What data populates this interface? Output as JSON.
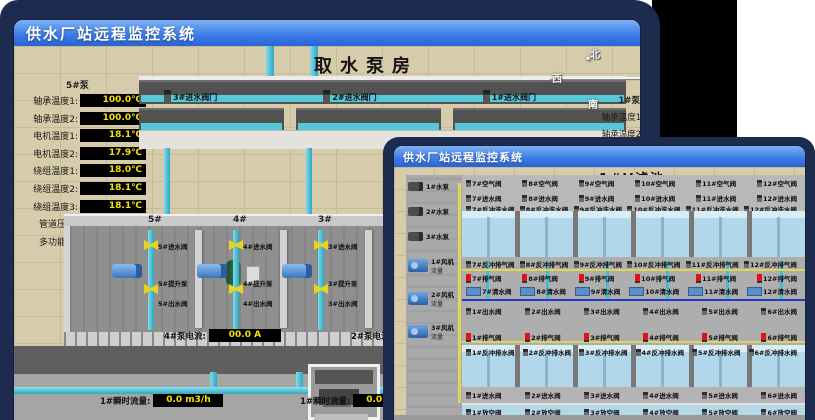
{
  "colors": {
    "background_navy": "#1d2b4e",
    "titlebar_top": "#7db1f5",
    "titlebar_bottom": "#2a63d4",
    "floor_tan": "#d6cbaa",
    "pipe_cyan": "#45bcd4",
    "pool_blue": "#b3d7ea",
    "value_yellow": "#f6e200",
    "valve_yellow": "#e8d41e",
    "alarm_red": "#e11212"
  },
  "back_window": {
    "title": "供水厂站远程监控系统",
    "scene_title": "取水泵房",
    "pump_panel": {
      "header": "5#泵",
      "readings": [
        {
          "label": "轴承温度1:",
          "value": "100.0℃"
        },
        {
          "label": "轴承温度2:",
          "value": "100.0℃"
        },
        {
          "label": "电机温度1:",
          "value": "18.1℃"
        },
        {
          "label": "电机温度2:",
          "value": "17.9℃"
        },
        {
          "label": "绕组温度1:",
          "value": "18.0℃"
        },
        {
          "label": "绕组温度2:",
          "value": "18.1℃"
        },
        {
          "label": "绕组温度3:",
          "value": "18.1℃"
        },
        {
          "label": "管道压力:",
          "value": "0.0007MPa"
        },
        {
          "label": "多功能阀:",
          "value": "0%"
        }
      ]
    },
    "intake_valves": [
      "3#进水阀门",
      "2#进水阀门",
      "1#进水阀门"
    ],
    "compass": {
      "north": "北",
      "west": "西",
      "south": "南",
      "east": "东"
    },
    "right_panel": {
      "header": "1#泵",
      "labels": [
        "轴承温度1:",
        "轴承温度2:"
      ]
    },
    "pump_bays": [
      {
        "bay": "5#",
        "inlet": "5#进水阀",
        "pump": "5#提升泵",
        "outlet": "5#出水阀"
      },
      {
        "bay": "4#",
        "inlet": "4#进水阀",
        "pump": "4#提升泵",
        "outlet": "4#出水阀"
      },
      {
        "bay": "3#",
        "inlet": "3#进水阀",
        "pump": "3#提升泵",
        "outlet": "3#出水阀"
      }
    ],
    "current_readings": [
      {
        "label": "4#泵电流:",
        "value": "00.0 A"
      },
      {
        "label": "2#泵电流:",
        "value": ""
      }
    ],
    "flow_readings": [
      {
        "label": "1#瞬时流量:",
        "value": "0.0 m3/h"
      },
      {
        "label": "1#瞬时流量:",
        "value": "0.0 m3/h"
      }
    ]
  },
  "front_window": {
    "title": "供水厂站远程监控系统",
    "scene_title": "1#V滤池",
    "left_equipment": {
      "pumps": [
        "1#水泵",
        "2#水泵",
        "3#水泵"
      ],
      "blowers": [
        {
          "name": "1#风机",
          "sub": "流量"
        },
        {
          "name": "2#风机",
          "sub": "流量"
        },
        {
          "name": "3#风机",
          "sub": "流量"
        }
      ]
    },
    "top_cells": [
      {
        "id": "7#",
        "air": "7#空气阀",
        "inlet": "7#进水阀",
        "backwash": "7#反冲洗水阀",
        "bw_vent": "7#反冲排气阀",
        "vent": "7#排气阀",
        "clean": "7#清水阀"
      },
      {
        "id": "8#",
        "air": "8#空气阀",
        "inlet": "8#进水阀",
        "backwash": "8#反冲洗水阀",
        "bw_vent": "8#反冲排气阀",
        "vent": "8#排气阀",
        "clean": "8#清水阀"
      },
      {
        "id": "9#",
        "air": "9#空气阀",
        "inlet": "9#进水阀",
        "backwash": "9#反冲洗水阀",
        "bw_vent": "9#反冲排气阀",
        "vent": "9#排气阀",
        "clean": "9#清水阀"
      },
      {
        "id": "10#",
        "air": "10#空气阀",
        "inlet": "10#进水阀",
        "backwash": "10#反冲洗水阀",
        "bw_vent": "10#反冲排气阀",
        "vent": "10#排气阀",
        "clean": "10#清水阀"
      },
      {
        "id": "11#",
        "air": "11#空气阀",
        "inlet": "11#进水阀",
        "backwash": "11#反冲洗水阀",
        "bw_vent": "11#反冲排气阀",
        "vent": "11#排气阀",
        "clean": "11#清水阀"
      },
      {
        "id": "12#",
        "air": "12#空气阀",
        "inlet": "12#进水阀",
        "backwash": "12#反冲洗水阀",
        "bw_vent": "12#反冲排气阀",
        "vent": "12#排气阀",
        "clean": "12#清水阀"
      }
    ],
    "bottom_cells": [
      {
        "id": "1#",
        "outlet": "1#出水阀",
        "vent": "1#排气阀",
        "drain": "1#反冲排水阀",
        "inlet": "1#进水阀",
        "empty": "1#放空阀"
      },
      {
        "id": "2#",
        "outlet": "2#出水阀",
        "vent": "2#排气阀",
        "drain": "2#反冲排水阀",
        "inlet": "2#进水阀",
        "empty": "2#放空阀"
      },
      {
        "id": "3#",
        "outlet": "3#出水阀",
        "vent": "3#排气阀",
        "drain": "3#反冲排水阀",
        "inlet": "3#进水阀",
        "empty": "3#放空阀"
      },
      {
        "id": "4#",
        "outlet": "4#出水阀",
        "vent": "4#排气阀",
        "drain": "4#反冲排水阀",
        "inlet": "4#进水阀",
        "empty": "4#放空阀"
      },
      {
        "id": "5#",
        "outlet": "5#出水阀",
        "vent": "5#排气阀",
        "drain": "5#反冲排水阀",
        "inlet": "5#进水阀",
        "empty": "5#放空阀"
      },
      {
        "id": "6#",
        "outlet": "6#出水阀",
        "vent": "6#排气阀",
        "drain": "6#反冲排水阀",
        "inlet": "6#进水阀",
        "empty": "6#放空阀"
      }
    ]
  }
}
